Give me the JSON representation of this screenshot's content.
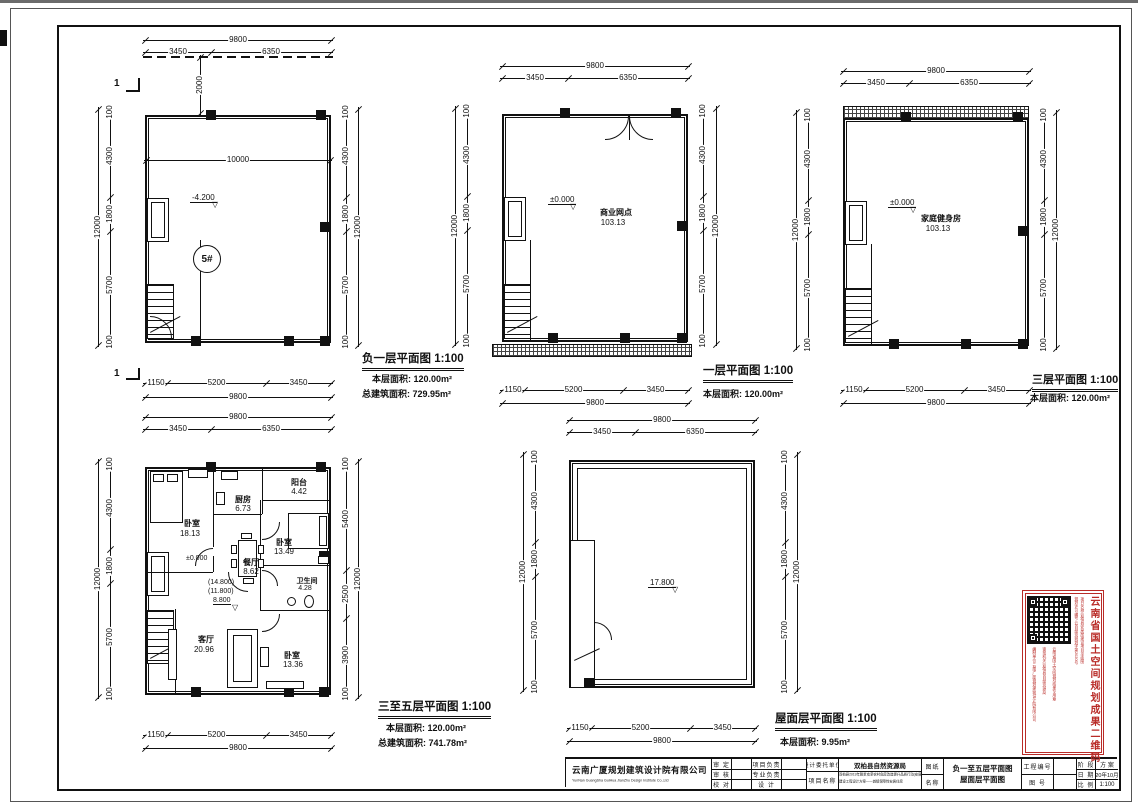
{
  "sheet": {
    "section_mark": "1"
  },
  "plans": {
    "basement": {
      "title": "负一层平面图",
      "scale": "1:100",
      "area_label": "本层面积:",
      "area": "120.00m²",
      "total_label": "总建筑面积:",
      "total_area": "729.95m²",
      "unit": "5#",
      "level": "-4.200",
      "interior_width": "10000",
      "setback": "2000",
      "dims": {
        "top_total": "9800",
        "top": [
          "3450",
          "6350"
        ],
        "bottom": [
          "1150",
          "5200",
          "3450"
        ],
        "bottom_total": "9800",
        "side": [
          "100",
          "4300",
          "1800",
          "5700",
          "100"
        ],
        "side_total": "12000"
      }
    },
    "first": {
      "title": "一层平面图",
      "scale": "1:100",
      "area_label": "本层面积:",
      "area": "120.00m²",
      "room": "商业网点",
      "room_area": "103.13",
      "level": "±0.000",
      "dims": {
        "top_total": "9800",
        "top": [
          "3450",
          "6350"
        ],
        "bottom": [
          "1150",
          "5200",
          "3450"
        ],
        "bottom_total": "9800",
        "side": [
          "100",
          "4300",
          "1800",
          "5700",
          "100"
        ],
        "side_total": "12000"
      }
    },
    "third": {
      "title": "三层平面图",
      "scale": "1:100",
      "area_label": "本层面积:",
      "area": "120.00m²",
      "room": "家庭健身房",
      "room_area": "103.13",
      "level": "±0.000",
      "dims": {
        "top_total": "9800",
        "top": [
          "3450",
          "6350"
        ],
        "bottom": [
          "1150",
          "5200",
          "3450"
        ],
        "bottom_total": "9800",
        "side": [
          "100",
          "4300",
          "1800",
          "5700",
          "100"
        ],
        "side_total": "12000"
      }
    },
    "typical": {
      "title": "三至五层平面图",
      "scale": "1:100",
      "area_label": "本层面积:",
      "area": "120.00m²",
      "total_label": "总建筑面积:",
      "total_area": "741.78m²",
      "level_zero": "±0.000",
      "levels": [
        "(14.800)",
        "(11.800)",
        "8.800"
      ],
      "rooms": [
        {
          "name": "卧室",
          "area": "18.13"
        },
        {
          "name": "厨房",
          "area": "6.73"
        },
        {
          "name": "阳台",
          "area": "4.42"
        },
        {
          "name": "卧室",
          "area": "13.49"
        },
        {
          "name": "餐厅",
          "area": "8.62"
        },
        {
          "name": "卫生间",
          "area": "4.28"
        },
        {
          "name": "客厅",
          "area": "20.96"
        },
        {
          "name": "卧室",
          "area": "13.36"
        }
      ],
      "dims": {
        "top_total": "9800",
        "top": [
          "3450",
          "6350"
        ],
        "bottom": [
          "1150",
          "5200",
          "3450"
        ],
        "bottom_total": "9800",
        "side": [
          "100",
          "4300",
          "1800",
          "5700",
          "100"
        ],
        "side_total": "12000",
        "right": [
          "100",
          "5400",
          "2500",
          "3900",
          "100"
        ]
      }
    },
    "roof": {
      "title": "屋面层平面图",
      "scale": "1:100",
      "area_label": "本层面积:",
      "area": "9.95m²",
      "level": "17.800",
      "dims": {
        "top_total": "9800",
        "top": [
          "3450",
          "6350"
        ],
        "bottom": [
          "1150",
          "5200",
          "3450"
        ],
        "bottom_total": "9800",
        "side": [
          "100",
          "4300",
          "1800",
          "5700",
          "100"
        ],
        "side_total": "12000"
      }
    }
  },
  "titleblock": {
    "company_cn": "云南广厦规划建筑设计院有限公司",
    "company_en": "YunNan GuangSha GuiHua JianZhu Design Institute Co.,Ltd",
    "sign_labels": [
      "审 定",
      "审 核",
      "校 对"
    ],
    "role_labels": [
      "项目负责",
      "专业负责",
      "设 计"
    ],
    "client_label": "设计委托单位",
    "client": "双柏县自然资源局",
    "project_label": "项目名称",
    "project_line1": "双柏县2019年脱贫攻坚农村危房改造提升品质行动(安居房)建设项目",
    "project_line2": "建设工程设计方案——城镇保障性安居住房",
    "sheet_label_1": "图纸",
    "sheet_label_2": "名称",
    "sheet_name_1": "负一至五层平面图",
    "sheet_name_2": "屋面层平面图",
    "project_no_label": "工程编号",
    "drawing_no_label": "图  号",
    "stage_label": "阶 段",
    "stage": "方 案",
    "date_label": "日 期",
    "date": "20年10月",
    "scale_label": "比 例",
    "scale": "1:100"
  },
  "stamp": {
    "title": "云南省国土空间规划成果二维码",
    "notes": [
      "规划许可编号:云自然资规划字第2020号",
      "项目名称:双柏县安居房建设项目平面图",
      "编制单位:云南广厦规划建筑设计院有限公司",
      "审批机关:双柏县自然资源局",
      "云南省国土空间规划成果专用章"
    ]
  }
}
